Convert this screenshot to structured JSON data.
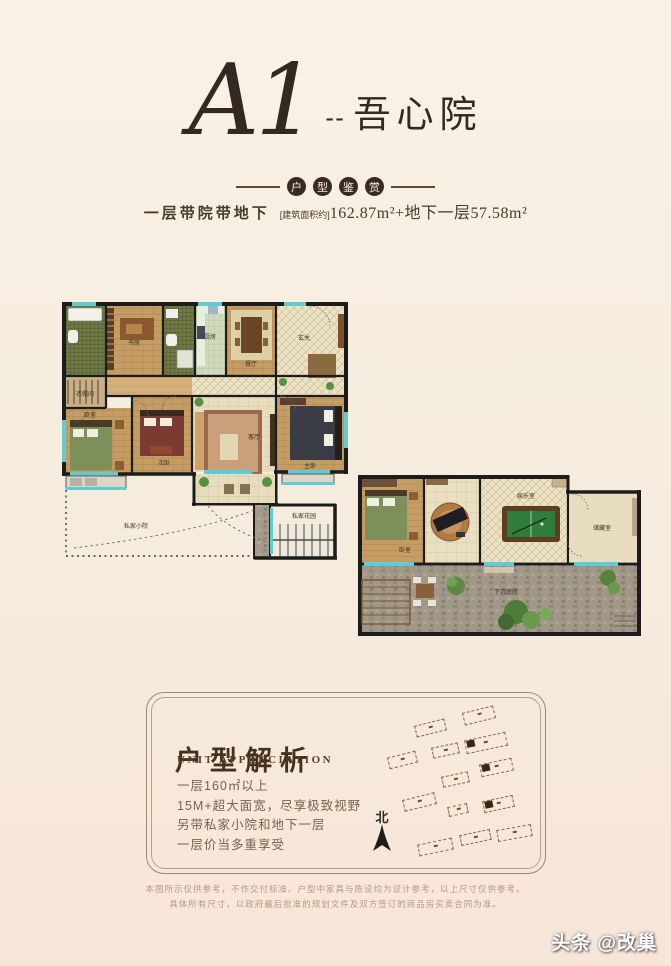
{
  "page": {
    "bg_top": "#f8f2e6",
    "bg_bottom": "#f7e5d8",
    "accent_dark": "#3b2a1f",
    "window_cyan": "#5fcbd3"
  },
  "header": {
    "unit_code": "A1",
    "dashes": "--",
    "unit_name": "吾心院",
    "badge_chars": [
      "户",
      "型",
      "鉴",
      "赏"
    ],
    "subtitle_label": "一层带院带地下",
    "area_bracket": "[建筑面积约]",
    "area_value": "162.87m²",
    "area_extra": "+地下一层57.58m²"
  },
  "floorplan_first": {
    "rooms": {
      "study": "书房",
      "kitchen": "厨房",
      "dining": "餐厅",
      "entry": "玄关",
      "closet": "衣帽间",
      "bed_left": "卧室",
      "bed_mid": "次卧",
      "living": "客厅",
      "bed_right": "主卧",
      "courtyard": "私家小院",
      "garden": "私家花园"
    }
  },
  "floorplan_basement": {
    "rooms": {
      "bedroom": "卧室",
      "games": "娱乐室",
      "storage": "储藏室",
      "courtyard": "下沉庭院"
    }
  },
  "analysis": {
    "title": "户型解析",
    "subtitle": "UNIT APPRECIATION",
    "points": [
      "一层160㎡以上",
      "15M+超大面宽，尽享极致视野",
      "另带私家小院和地下一层",
      "一层价当多重享受"
    ],
    "compass_label": "北"
  },
  "siteplan": {
    "buildings": [
      {
        "x": 316,
        "y": 16,
        "w": 30,
        "h": 11,
        "rot": -14,
        "hl": false
      },
      {
        "x": 268,
        "y": 29,
        "w": 29,
        "h": 10,
        "rot": -14,
        "hl": false
      },
      {
        "x": 318,
        "y": 43,
        "w": 40,
        "h": 12,
        "rot": -12,
        "hl": true
      },
      {
        "x": 285,
        "y": 52,
        "w": 25,
        "h": 9,
        "rot": -12,
        "hl": false
      },
      {
        "x": 241,
        "y": 61,
        "w": 27,
        "h": 10,
        "rot": -14,
        "hl": false
      },
      {
        "x": 333,
        "y": 68,
        "w": 31,
        "h": 11,
        "rot": -12,
        "hl": true
      },
      {
        "x": 295,
        "y": 81,
        "w": 25,
        "h": 9,
        "rot": -12,
        "hl": false
      },
      {
        "x": 256,
        "y": 103,
        "w": 31,
        "h": 10,
        "rot": -14,
        "hl": false
      },
      {
        "x": 301,
        "y": 112,
        "w": 18,
        "h": 8,
        "rot": -12,
        "hl": false
      },
      {
        "x": 336,
        "y": 105,
        "w": 29,
        "h": 10,
        "rot": -12,
        "hl": true
      },
      {
        "x": 271,
        "y": 148,
        "w": 33,
        "h": 10,
        "rot": -12,
        "hl": false
      },
      {
        "x": 313,
        "y": 139,
        "w": 29,
        "h": 9,
        "rot": -12,
        "hl": false
      },
      {
        "x": 350,
        "y": 134,
        "w": 33,
        "h": 10,
        "rot": -10,
        "hl": false
      }
    ]
  },
  "disclaimer": {
    "line1": "本图所示仅供参考，不作交付标准。户型中家具与陈设均为设计参考，以上尺寸仅供参考。",
    "line2": "具体所有尺寸，以政府最后批准的规划文件及双方签订的商品房买卖合同为准。"
  },
  "watermark": "头条 @改巢"
}
